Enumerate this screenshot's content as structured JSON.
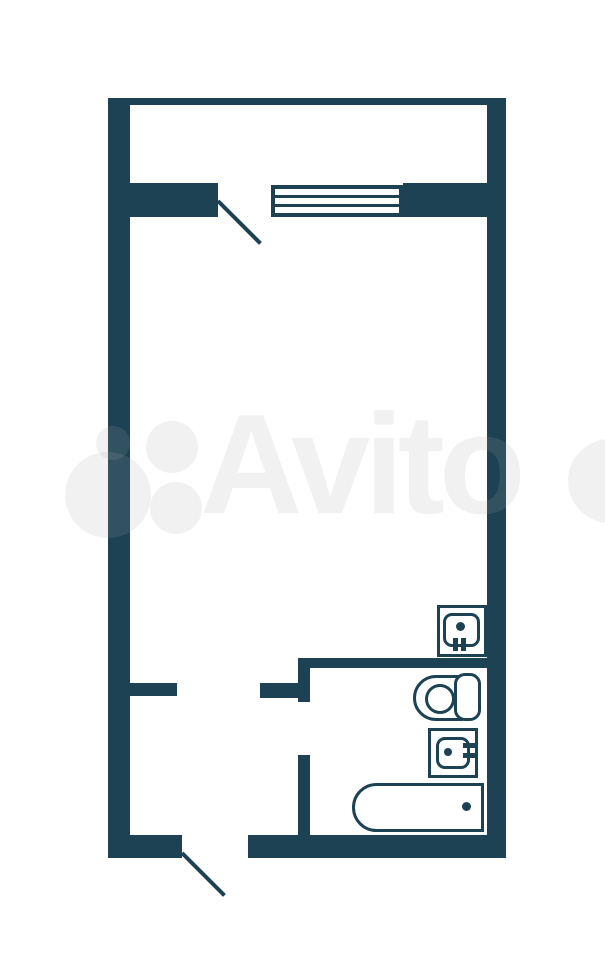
{
  "canvas": {
    "width": 605,
    "height": 960,
    "background": "#ffffff"
  },
  "colors": {
    "wall": "#1d4254",
    "watermark": "rgba(168,168,168,0.16)"
  },
  "watermark": {
    "text": "Avito",
    "text_left": 200,
    "text_top": 394,
    "font_size": 142,
    "circles": [
      {
        "name": "avito-logo-circle-small",
        "x": 96,
        "y": 426,
        "d": 34
      },
      {
        "name": "avito-logo-circle-top",
        "x": 146,
        "y": 421,
        "d": 52
      },
      {
        "name": "avito-logo-circle-big",
        "x": 65,
        "y": 452,
        "d": 86
      },
      {
        "name": "avito-logo-circle-bottom",
        "x": 150,
        "y": 482,
        "d": 52
      },
      {
        "name": "avito-logo-circle-edge",
        "x": 568,
        "y": 439,
        "d": 84
      }
    ]
  },
  "floorplan": {
    "walls": [
      {
        "name": "wall-top",
        "x": 108,
        "y": 98,
        "w": 398,
        "h": 7
      },
      {
        "name": "wall-left",
        "x": 108,
        "y": 98,
        "w": 22,
        "h": 760
      },
      {
        "name": "wall-right",
        "x": 487,
        "y": 98,
        "w": 19,
        "h": 760
      },
      {
        "name": "wall-bottom-left",
        "x": 108,
        "y": 835,
        "w": 74,
        "h": 23
      },
      {
        "name": "wall-bottom-right",
        "x": 248,
        "y": 835,
        "w": 258,
        "h": 23
      },
      {
        "name": "wall-loggia-left",
        "x": 130,
        "y": 183,
        "w": 88,
        "h": 34
      },
      {
        "name": "wall-loggia-right",
        "x": 403,
        "y": 183,
        "w": 84,
        "h": 34
      },
      {
        "name": "wall-hall-stub-left",
        "x": 130,
        "y": 683,
        "w": 47,
        "h": 13
      },
      {
        "name": "wall-hall-stub-right",
        "x": 260,
        "y": 683,
        "w": 50,
        "h": 15
      },
      {
        "name": "wall-bath-vertical-upper",
        "x": 298,
        "y": 658,
        "w": 12,
        "h": 44
      },
      {
        "name": "wall-bath-vertical-lower",
        "x": 298,
        "y": 755,
        "w": 12,
        "h": 80
      },
      {
        "name": "wall-bath-top",
        "x": 298,
        "y": 658,
        "w": 189,
        "h": 10
      }
    ],
    "window": {
      "name": "window-loggia",
      "x": 271,
      "y": 185,
      "w": 132,
      "h": 32,
      "border": 4,
      "line_h": 3,
      "line_tops": [
        6,
        15
      ]
    },
    "door_swings": [
      {
        "name": "door-swing-balcony",
        "x": 218,
        "y": 201,
        "len": 60,
        "angle": 45,
        "t": 4
      },
      {
        "name": "door-swing-entrance",
        "x": 182,
        "y": 853,
        "len": 60,
        "angle": 45,
        "t": 4
      }
    ],
    "fixtures": {
      "kitchen_sink": {
        "name": "kitchen-sink-icon",
        "outer": {
          "x": 437,
          "y": 605,
          "w": 50,
          "h": 52
        },
        "basin": {
          "x": 443,
          "y": 613,
          "w": 37,
          "h": 34,
          "r": 9
        },
        "dot": {
          "x": 456,
          "y": 622,
          "d": 9
        },
        "prongs": [
          {
            "x": 453,
            "y": 638,
            "w": 5,
            "h": 13
          },
          {
            "x": 461,
            "y": 638,
            "w": 5,
            "h": 13
          }
        ]
      },
      "washbasin": {
        "name": "washbasin-icon",
        "outer": {
          "x": 428,
          "y": 728,
          "w": 50,
          "h": 50
        },
        "basin": {
          "x": 436,
          "y": 737,
          "w": 34,
          "h": 32,
          "r": 9
        },
        "dot": {
          "x": 444,
          "y": 748,
          "d": 8
        },
        "prongs": [
          {
            "x": 463,
            "y": 743,
            "w": 13,
            "h": 5
          },
          {
            "x": 463,
            "y": 753,
            "w": 13,
            "h": 5
          }
        ]
      },
      "toilet": {
        "name": "toilet-icon",
        "bowl": {
          "x": 413,
          "y": 675,
          "w": 50,
          "h": 46,
          "r_left": 23
        },
        "tank": {
          "x": 454,
          "y": 673,
          "w": 27,
          "h": 48,
          "r": 11
        },
        "circle": {
          "x": 425,
          "y": 684,
          "d": 30
        }
      },
      "bathtub": {
        "name": "bathtub-icon",
        "body": {
          "x": 352,
          "y": 783,
          "w": 132,
          "h": 49,
          "r_left": 25
        },
        "dot": {
          "x": 462,
          "y": 802,
          "d": 9
        }
      }
    }
  }
}
